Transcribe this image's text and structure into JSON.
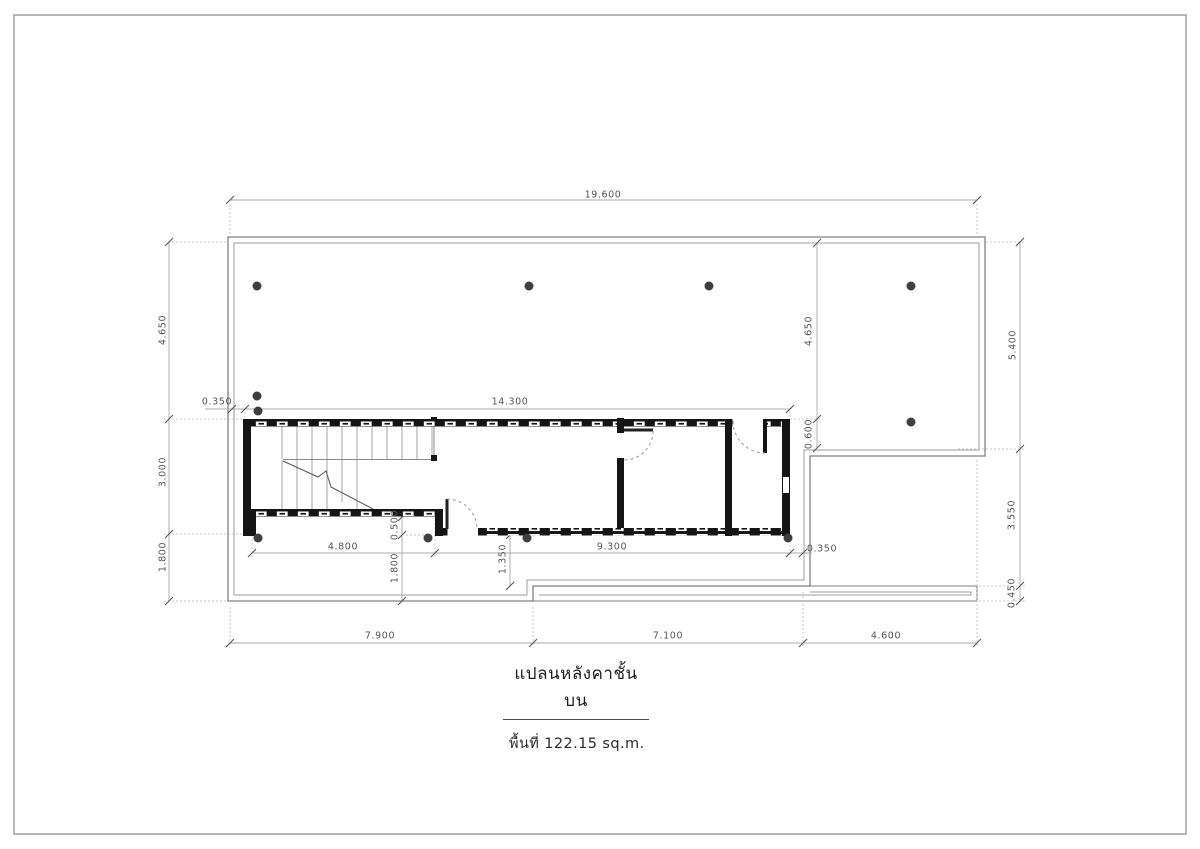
{
  "drawing": {
    "title": "แปลนหลังคาชั้นบน",
    "area_label": "พื้นที่ 122.15  sq.m."
  },
  "colors": {
    "wall": "#151515",
    "outline": "#808186",
    "outline_inner": "#9b9ca0",
    "dimension_line": "#a9aaae",
    "dimension_text": "#55565a",
    "column_dot": "#3f3f41",
    "page_border": "#9a9a9e"
  },
  "dimensions": [
    {
      "text": "19.600",
      "x": 603,
      "y": 195,
      "rot": false
    },
    {
      "text": "0.350",
      "x": 217,
      "y": 402,
      "rot": false
    },
    {
      "text": "14.300",
      "x": 510,
      "y": 402,
      "rot": false
    },
    {
      "text": "4.800",
      "x": 343,
      "y": 547,
      "rot": false
    },
    {
      "text": "9.300",
      "x": 612,
      "y": 547,
      "rot": false
    },
    {
      "text": "0.350",
      "x": 822,
      "y": 549,
      "rot": false
    },
    {
      "text": "7.900",
      "x": 380,
      "y": 636,
      "rot": false
    },
    {
      "text": "7.100",
      "x": 668,
      "y": 636,
      "rot": false
    },
    {
      "text": "4.600",
      "x": 886,
      "y": 636,
      "rot": false
    },
    {
      "text": "4.650",
      "x": 163,
      "y": 330,
      "rot": true
    },
    {
      "text": "3.000",
      "x": 163,
      "y": 472,
      "rot": true
    },
    {
      "text": "1.800",
      "x": 163,
      "y": 557,
      "rot": true
    },
    {
      "text": "4.650",
      "x": 809,
      "y": 331,
      "rot": true
    },
    {
      "text": "0.600",
      "x": 809,
      "y": 434,
      "rot": true
    },
    {
      "text": "0.500",
      "x": 395,
      "y": 525,
      "rot": true
    },
    {
      "text": "1.800",
      "x": 395,
      "y": 568,
      "rot": true
    },
    {
      "text": "1.350",
      "x": 503,
      "y": 559,
      "rot": true
    },
    {
      "text": "5.400",
      "x": 1013,
      "y": 345,
      "rot": true
    },
    {
      "text": "3.550",
      "x": 1012,
      "y": 515,
      "rot": true
    },
    {
      "text": "0.450",
      "x": 1012,
      "y": 593,
      "rot": true
    }
  ]
}
